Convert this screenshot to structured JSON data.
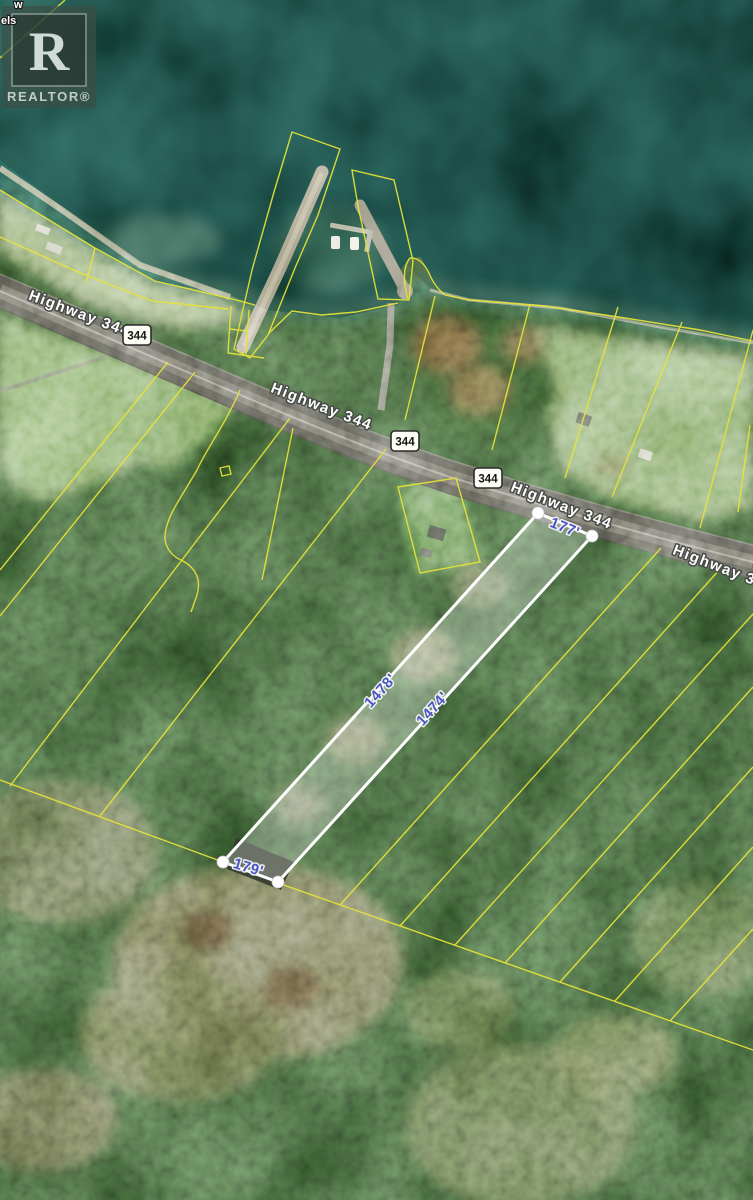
{
  "map": {
    "type": "satellite-parcel-map",
    "corner_fragments": {
      "top": "w",
      "left": "els"
    },
    "watermark": {
      "letter": "R",
      "label": "REALTOR®"
    }
  },
  "road": {
    "name_labels": [
      {
        "text": "Highway 344"
      },
      {
        "text": "Highway 344"
      },
      {
        "text": "Highway 344"
      },
      {
        "text": "Highway 344"
      }
    ],
    "shields": [
      {
        "text": "344"
      },
      {
        "text": "344"
      },
      {
        "text": "344"
      }
    ]
  },
  "parcel": {
    "side_lengths": {
      "top": "177'",
      "left": "1478'",
      "right": "1474'",
      "bottom": "179'"
    }
  },
  "colors": {
    "water": "#113b34",
    "forest": "#33522c",
    "boundary_yellow": "#e8e438",
    "parcel_outline": "#ffffff",
    "dimension_blue": "#4a56c6",
    "road_gray": "#55544b"
  }
}
